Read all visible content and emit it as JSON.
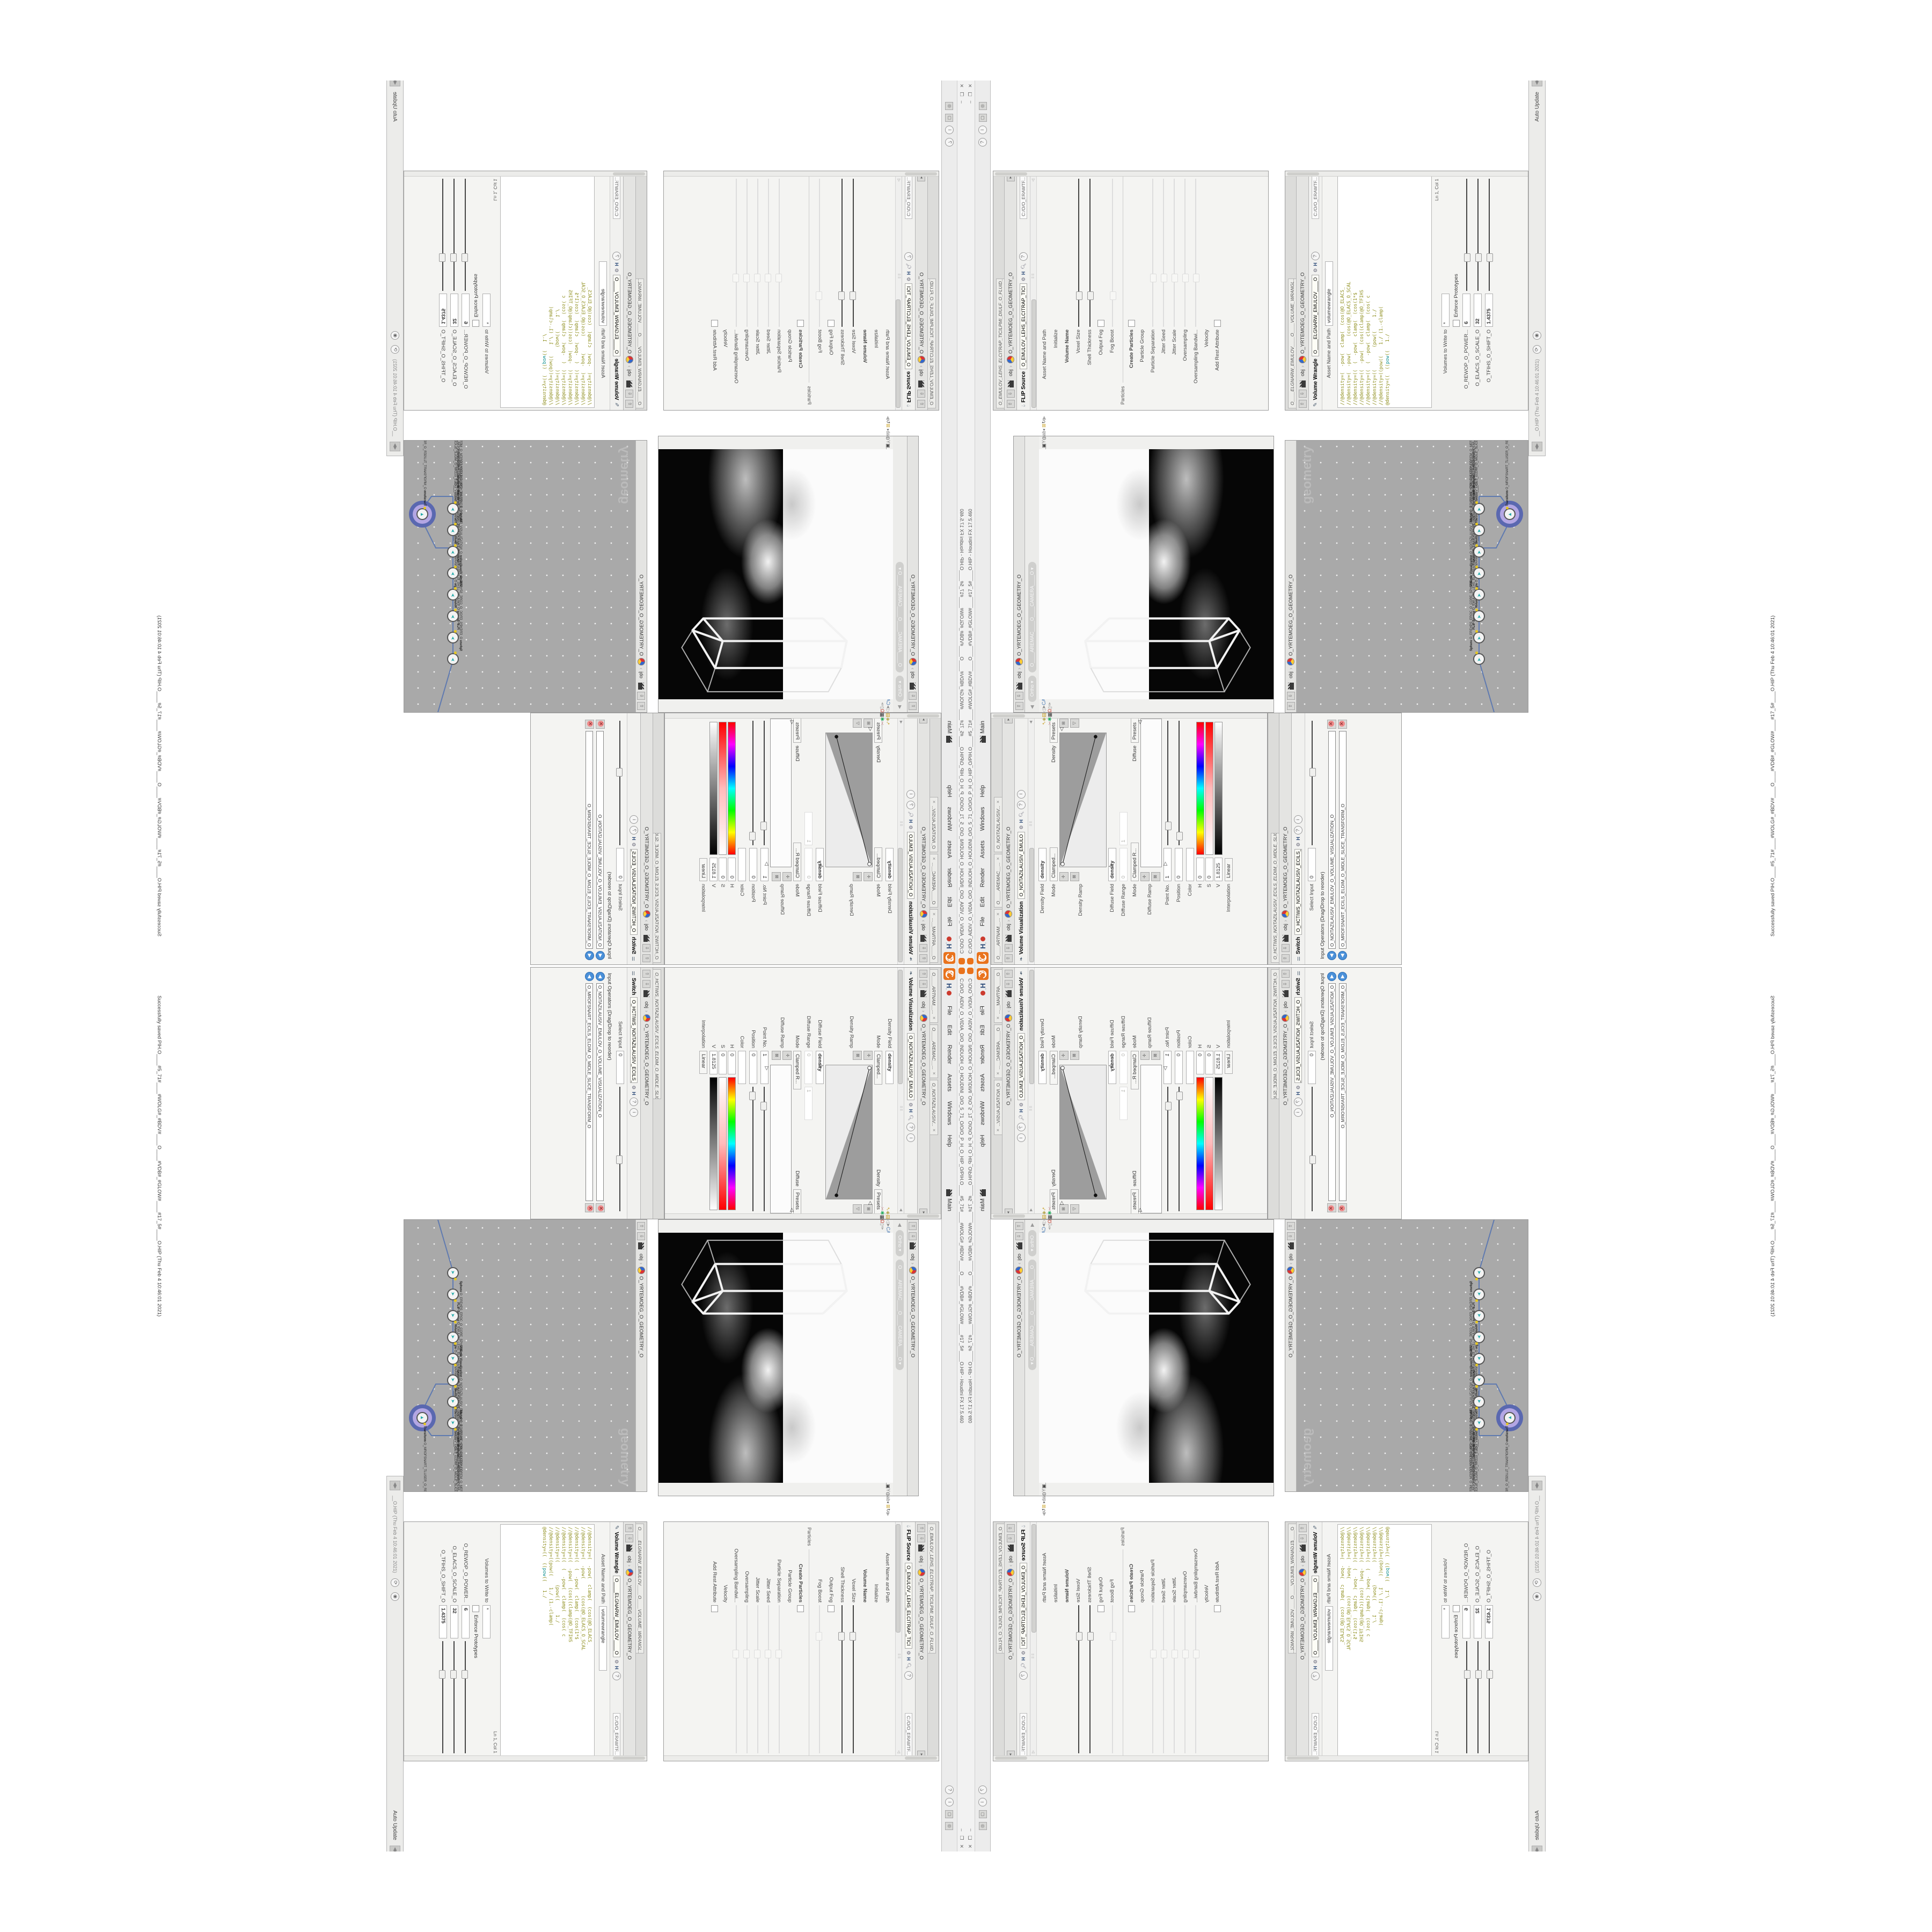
{
  "window": {
    "title": "C:/O/O_AIDIV_O_VIDIA_O/O_INDUOH_O_HOUDINI_O/O_5_71_O/O/O_P_H_O_HIP_O/PIH.O____#5_71#____#WOLG#_#BDV#____O____#VDB#_#GLOW#____#17_5#____O.HIP - Houdini FX 17.5.460",
    "status_message": "Successfully saved PIH.O____#5_71#____#WOLG#_#BDV#____O____#VDB#_#GLOW#____#17_5#____O.HIP (Thu Feb 4 10:46:01 2021)",
    "controls": [
      "–",
      "❐",
      "✕"
    ]
  },
  "menubar": {
    "items": [
      {
        "label": "File"
      },
      {
        "label": "Edit"
      },
      {
        "label": "Render"
      },
      {
        "label": "Assets"
      },
      {
        "label": "Windows"
      },
      {
        "label": "Help"
      }
    ],
    "desktop_label": "Main",
    "help_icon": "?",
    "info_icon": "i"
  },
  "context": {
    "network_tab": "obj",
    "geometry_tab": "O_YRTEMOEG_O_GEOMETRY_O"
  },
  "flip": {
    "pane_title": "O_EMULOV_LEHS_ELCITRAP_TICILPMI_DIULF_O_FLUID_IMPLICIT_PARTI...",
    "type_label": "FLIP Source",
    "node_name": "O_EMULOV_LEHS_ELCITRAP_TICI",
    "path_field": "C:/O/O_ERAWTF...",
    "params": [
      {
        "label": "Asset Name and Path",
        "value": "flipsource",
        "value2": "Source FLIP"
      },
      {
        "label": "Initialize",
        "value": ""
      },
      {
        "label": "Volume Name",
        "value": "density",
        "bold": true
      },
      {
        "label": "Voxel Size",
        "value": "1/27",
        "highlight": true,
        "slider": true
      },
      {
        "label": "Shell Thickness",
        "value": "3",
        "slider": true
      },
      {
        "label": "Output Fog",
        "checkbox": true
      },
      {
        "label": "Fog Boost",
        "value": "0",
        "disabled": true,
        "slider": true
      }
    ],
    "particles_section": "Particles",
    "particles": [
      {
        "label": "Create Particles",
        "checkbox": true,
        "bold": true
      },
      {
        "label": "Particle Group",
        "value": "particles",
        "disabled": true
      },
      {
        "label": "Particle Separation",
        "value": "1/9",
        "disabled": true,
        "slider": true
      },
      {
        "label": "Jitter Seed",
        "value": "0",
        "disabled": true,
        "slider": true
      },
      {
        "label": "Jitter Scale",
        "value": "0",
        "disabled": true,
        "slider": true
      },
      {
        "label": "Oversampling",
        "value": "2",
        "disabled": true,
        "slider": true
      },
      {
        "label": "Oversampling Bandwi...",
        "value": "1",
        "disabled": true,
        "slider": true
      },
      {
        "label": "Velocity",
        "value": "0",
        "value2": "0",
        "disabled": true
      },
      {
        "label": "Add Rest Attribute",
        "checkbox": true,
        "disabled": true
      }
    ]
  },
  "wrangle": {
    "pane_title": "O____ELGNARW_EMULOV____O____VOLUME_WRANGL...",
    "type_label": "Volume Wrangle",
    "node_name": "O____ELGNARW_EMULOV____O",
    "path_field": "C:/O/O_ERAWTF...",
    "asset_label": "Asset Name and Path",
    "asset_value": "volumewrangle",
    "code_lines": [
      "//@density=(  -pow(  clamp(  (cos(@O_ELACS_",
      "//@density=(  -pow(      (cos(@O_ELACS_O_SCAL",
      "//@density=((  (  -pow(  clamp(  (cos(1*$",
      "//@density=((  -pow(  (cos((clamp(@O_TFIHS",
      "//@density=((  (  -pow(  clamp(  (cos( c",
      "//@density=((        (pow((     1./",
      "//@density=((pow((    1./ (1.-clamp("
    ],
    "code_last": {
      "pre": "@density=((  ((",
      "fn": "pow",
      "post": "((   1./"
    },
    "cursor_pos": "Ln 1, Col 1",
    "volumes_label": "Volumes to Write to",
    "volumes_value": "*",
    "enforce_label": "Enforce Prototypes",
    "sliders": [
      {
        "label": "O_REWOP_O_POWER...",
        "value": "6"
      },
      {
        "label": "O_ELACS_O_SCALE_O",
        "value": "32"
      },
      {
        "label": "O_TFIHS_O_SHIFT_O",
        "value": "1.4375"
      }
    ]
  },
  "volvis": {
    "pane_tabs": [
      {
        "label": "O____ARTNAM__..."
      },
      {
        "label": "O____AREMAC__..."
      },
      {
        "label": "O_NOITAZILAUSIV..."
      }
    ],
    "type_label": "Volume Visualization",
    "node_name": "O_NOITAZILAUSIV_EMULO",
    "density_field_label": "Density Field",
    "density_field_value": "density",
    "mode1_label": "Mode",
    "mode1_value": "Clamped...",
    "density_label": "Density",
    "presets_label": "Presets",
    "density_ramp_label": "Density Ramp",
    "diffuse_field_label": "Diffuse Field",
    "diffuse_field_value": "density",
    "diffuse_range_label": "Diffuse Range",
    "diffuse_range_v1": "0",
    "diffuse_range_v2": "1",
    "mode2_label": "Mode",
    "mode2_value": "Clamped R...",
    "diffuse_label": "Diffuse",
    "presets2_label": "Presets",
    "diffuse_ramp_label": "Diffuse Ramp",
    "point_label": "Point No.",
    "point_value": "1",
    "position_label": "Position",
    "position_value": "0",
    "color_label": "Color",
    "h_label": "H",
    "h_value": "0",
    "s_label": "S",
    "s_value": "0",
    "v_label": "V",
    "v_value": "1.8125",
    "interp_label": "Interpolation",
    "interp_value": "Linear"
  },
  "switch": {
    "pane_title": "O_HCTIWS_NOITAZILAUSIV_ECILS_ELDIM_O_MIDLE_SLICE_VISUAL...",
    "type_label": "Switch",
    "node_name": "O_HCTIWS_NOITAZILAUSIV_ECILS_EL",
    "select_label": "Select Input",
    "select_value": "0",
    "list_header": "Input Operators (Drag/Drop to reorder)",
    "inputs": [
      {
        "label": "O_NOITAZILAUSIV_EMULOV_O_VOLUME_VISUALIZATION_O"
      },
      {
        "label": "O_MROFSNART_ECILS_ELDIM_O_MIDLE_SLICE_TRANSFORM_O"
      }
    ]
  },
  "viewport": {
    "ortho_label": "Ortho",
    "camera_label": "O____AREMAC____O____CAMERA____O",
    "left_icons": [
      {
        "g": "➴",
        "c": "#c9a227"
      },
      {
        "g": "◈",
        "c": "#b0a040"
      },
      {
        "g": "▤",
        "c": "#c9a227"
      },
      {
        "g": "◁",
        "c": "#999"
      },
      {
        "g": "➤",
        "c": "#888"
      },
      {
        "g": "CA",
        "c": "#4a7ab5"
      },
      {
        "g": "✚",
        "c": "#c0392b"
      },
      {
        "g": "↻",
        "c": "#d35400"
      },
      {
        "g": "✥",
        "c": "#c0392b"
      },
      {
        "g": "✂",
        "c": "#cc9999"
      },
      {
        "g": "✱",
        "c": "#27ae60"
      },
      {
        "g": "▦",
        "c": "#333333"
      },
      {
        "g": "Ω",
        "c": "#c0392b"
      },
      {
        "g": "▯",
        "c": "#999999"
      },
      {
        "g": "✑",
        "c": "#777777"
      }
    ],
    "right_icons": [
      {
        "g": "◀",
        "c": "#999"
      },
      {
        "g": "✎",
        "c": "#777"
      },
      {
        "g": "◨",
        "c": "#777"
      },
      {
        "g": "◇",
        "c": "#777"
      },
      {
        "g": "◆",
        "c": "#777"
      },
      {
        "g": "◟",
        "c": "#555"
      },
      {
        "g": "▣",
        "c": "#444"
      },
      {
        "g": "Y",
        "c": "#777"
      },
      {
        "g": "◍",
        "c": "#777"
      },
      {
        "g": "ab",
        "c": "#777"
      },
      {
        "g": "◐",
        "c": "#555"
      },
      {
        "g": "⊞",
        "c": "#c9a227"
      },
      {
        "g": "↻",
        "c": "#555"
      },
      {
        "g": "▶",
        "c": "#aaa"
      }
    ]
  },
  "network": {
    "watermark": "geometry",
    "nodes": [
      {
        "name": "Sphere",
        "label": "O_EREHPS_EROC_O_CORE_SPHERE_O"
      },
      {
        "name": "FLIP Source",
        "label": "O_EMULOV_LEHS_ELCITRAP_TICILPMI_DIULF_O_FLUID_IMPLICIT_PARTICLE_SHEL_VOLUME_O"
      },
      {
        "name": "Volume Wrangle",
        "label": "O____ELGNARW_EMULOV____O____VOLUME_WRANGLE____O1"
      },
      {
        "name": "Volume Visualization",
        "label": "O_NOITAZILAUSIV_EMULOV_O_VOLUME_VISUALIZATION_O"
      },
      {
        "name": "Transform",
        "label": "O_MROFSNART_ECILS_ELDIM_O_MIDLE_SLICE_TRANSFORM_O"
      },
      {
        "name": "Switch",
        "label": "O_HCTIWS_NOITAZILAUSIV_ECILS_ELDIM_O_MIDLE_SLICE_VISUALIZATION_SWITCH_O"
      },
      {
        "name": "Merge",
        "label": "O_ECAFRUS_HTIW_EMULOV_EGREM_O_MERGE_VOLUME_WITH_SURFACE_O"
      },
      {
        "name": "Volume Wrangle",
        "label": "O____ELGNARW_EMULOV____O____VOLUME_WRANGLE____O2"
      },
      {
        "name": "Transform",
        "label": "O_MROFSNART_TLUSER_O_RESULT_TRANSFORM_O",
        "selected": true
      }
    ],
    "auto_update": "Auto Update",
    "saved_path": "__O.HIP (Thu Feb 4 10:46:01 2021)"
  },
  "colors": {
    "houdini_orange": "#e9731d",
    "network_bg": "#a9a9a9",
    "node_selected_fill": "#b3a6e3",
    "node_selected_ring": "#5a68b0",
    "code_olive": "#8f8f1f",
    "code_teal": "#0f8f8f",
    "field_highlight": "#fdf9d8",
    "delete_red": "#ef8a8a",
    "input_blue": "#4a90d9"
  }
}
